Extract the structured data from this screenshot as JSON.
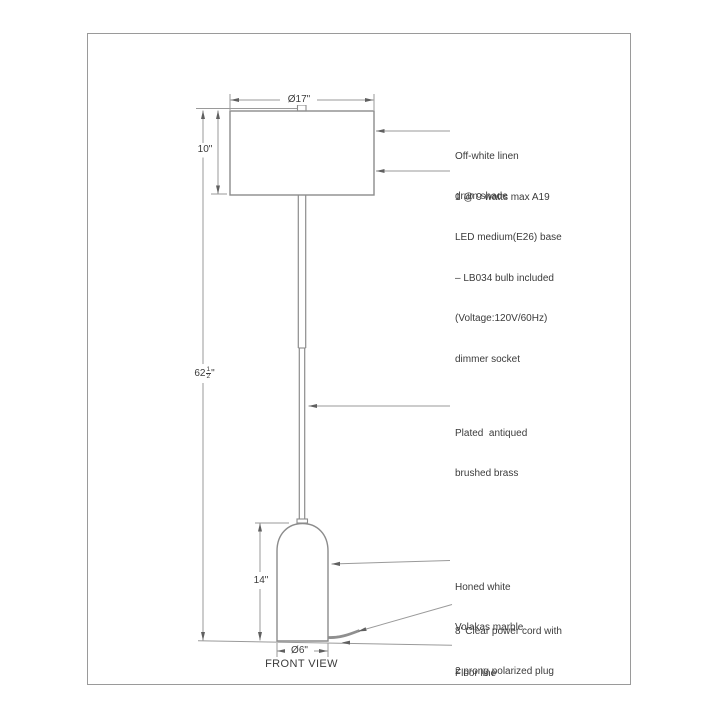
{
  "page": {
    "view_label": "FRONT VIEW"
  },
  "dimensions": {
    "shade_diameter": "Ø17\"",
    "shade_height": "10\"",
    "total_height": {
      "whole": "62",
      "numerator": "1",
      "denominator": "2",
      "unit": "\""
    },
    "base_height": "14\"",
    "base_diameter": "Ø6\""
  },
  "annotations": {
    "shade": [
      "Off-white linen",
      "drum shade"
    ],
    "socket": [
      "1 @ 9 watts max A19",
      "LED medium(E26) base",
      "– LB034 bulb included",
      "(Voltage:120V/60Hz)",
      "dimmer socket"
    ],
    "pole": [
      "Plated  antiqued",
      "brushed brass"
    ],
    "base": [
      "Honed white",
      "Volakas marble"
    ],
    "cord": [
      "8' Clear power cord with",
      "2 prong polarized plug"
    ],
    "floor": [
      "Floor line"
    ]
  },
  "colors": {
    "object_line": "#8c8c8c",
    "dimension_line": "#9a9a9a",
    "arrow": "#606060",
    "text": "#3b3b3b"
  }
}
